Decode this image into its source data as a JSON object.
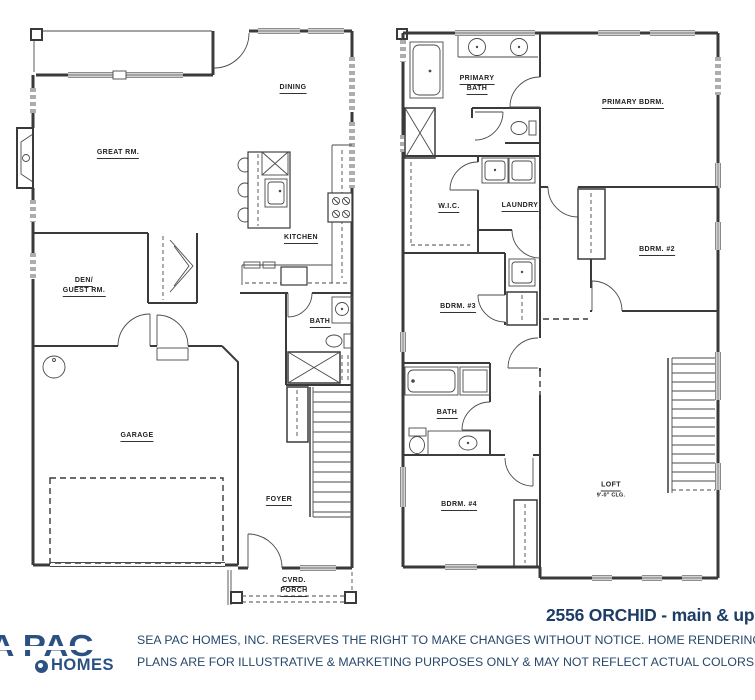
{
  "sheet": {
    "title": "2556 ORCHID - main & upper",
    "disclaimer1": "SEA PAC HOMES, INC. RESERVES THE RIGHT TO MAKE CHANGES WITHOUT NOTICE.  HOME RENDERINGS AND F",
    "disclaimer2": "PLANS ARE FOR ILLUSTRATIVE & MARKETING PURPOSES ONLY & MAY NOT REFLECT ACTUAL COLORS OR FEATU",
    "logo": {
      "name1": "SEA PAC",
      "name2": "HOMES"
    },
    "colors": {
      "title_navy": "#1d3c66",
      "logo_blue": "#2b5183",
      "line": "#3a3a3a",
      "disclaimer": "#27486b"
    }
  },
  "main_floor": {
    "dining": "DINING",
    "great_rm": "GREAT RM.",
    "kitchen": "KITCHEN",
    "den_line1": "DEN/",
    "den_line2": "GUEST RM.",
    "bath": "BATH",
    "garage": "GARAGE",
    "foyer": "FOYER",
    "porch_line1": "CVRD.",
    "porch_line2": "PORCH"
  },
  "upper_floor": {
    "primary_bath_line1": "PRIMARY",
    "primary_bath_line2": "BATH",
    "primary_bdrm": "PRIMARY BDRM.",
    "wic": "W.I.C.",
    "laundry": "LAUNDRY",
    "bdrm2": "BDRM. #2",
    "bdrm3": "BDRM. #3",
    "bath": "BATH",
    "bdrm4": "BDRM. #4",
    "loft": "LOFT",
    "loft_clg": "9'-0\" CLG."
  }
}
